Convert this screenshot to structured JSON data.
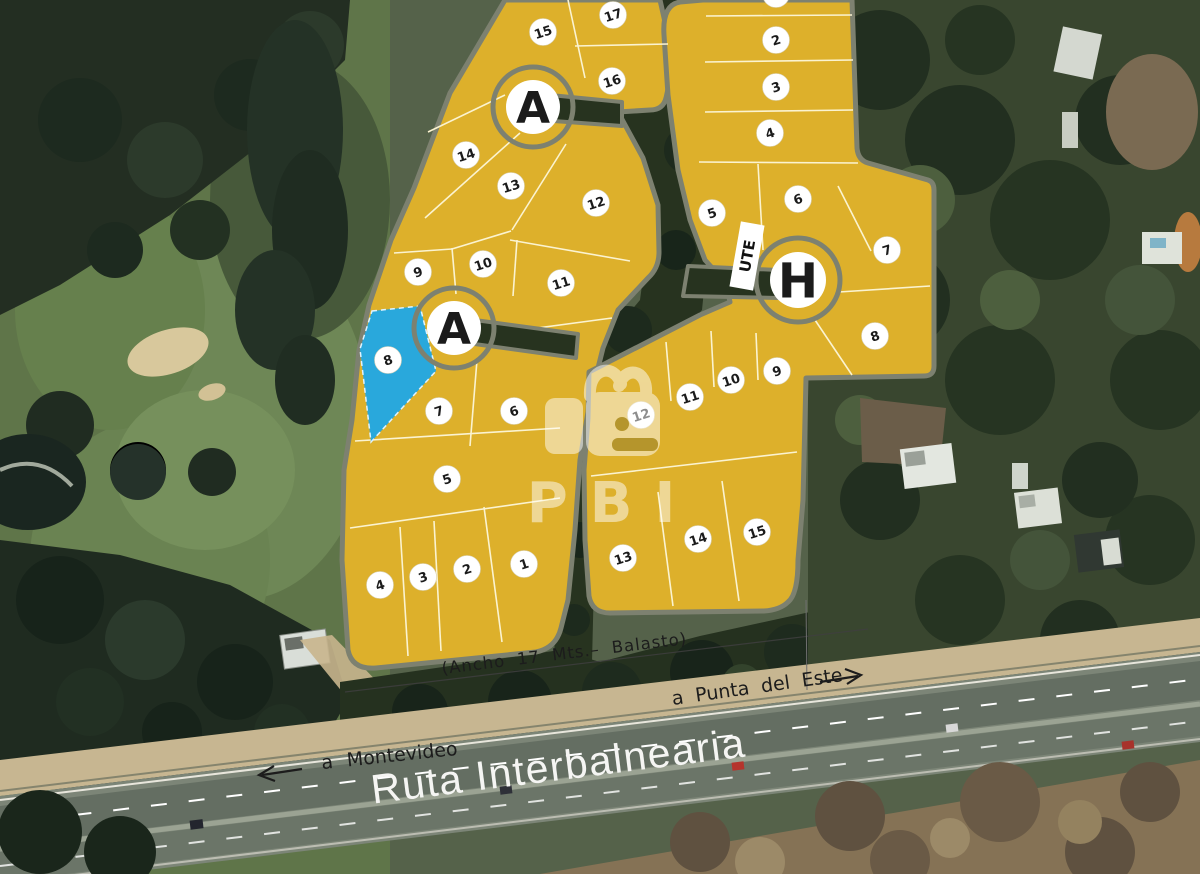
{
  "labels": {
    "route": "Ruta Interbalnearia",
    "to_left": "a  Montevideo",
    "to_right": "a  Punta del Este",
    "road_note": "(Ancho 17 Mts.– Balasto)",
    "utility": "UTE"
  },
  "watermark": {
    "brand": "PBI"
  },
  "colors": {
    "plot_fill": "#DDB02B",
    "plot_stroke": "#7D8170",
    "lot_line": "#FBF3D0",
    "highlight": "#29A8DC",
    "badge_bg": "#FFFFFF",
    "badge_ink": "#1B1B1B",
    "label_ink": "#1C1C1C",
    "route_text": "#F5F5F3"
  },
  "culdesacs": [
    {
      "label": "A",
      "x": 533,
      "y": 107,
      "r": 27,
      "ring": 40,
      "fs": 44
    },
    {
      "label": "A",
      "x": 454,
      "y": 328,
      "r": 27,
      "ring": 40,
      "fs": 44
    },
    {
      "label": "H",
      "x": 798,
      "y": 280,
      "r": 28,
      "ring": 42,
      "fs": 48
    }
  ],
  "sectors": [
    {
      "name": "A",
      "lots": [
        {
          "n": "17",
          "x": 613,
          "y": 15
        },
        {
          "n": "15",
          "x": 543,
          "y": 32
        },
        {
          "n": "16",
          "x": 612,
          "y": 81
        },
        {
          "n": "14",
          "x": 466,
          "y": 155
        },
        {
          "n": "13",
          "x": 511,
          "y": 186
        },
        {
          "n": "12",
          "x": 596,
          "y": 203
        },
        {
          "n": "9",
          "x": 418,
          "y": 272
        },
        {
          "n": "10",
          "x": 483,
          "y": 264
        },
        {
          "n": "11",
          "x": 561,
          "y": 283
        },
        {
          "n": "8",
          "x": 388,
          "y": 360,
          "highlighted": true
        },
        {
          "n": "7",
          "x": 439,
          "y": 411
        },
        {
          "n": "6",
          "x": 514,
          "y": 411
        },
        {
          "n": "5",
          "x": 447,
          "y": 479
        },
        {
          "n": "4",
          "x": 380,
          "y": 585
        },
        {
          "n": "3",
          "x": 423,
          "y": 577
        },
        {
          "n": "2",
          "x": 467,
          "y": 569
        },
        {
          "n": "1",
          "x": 524,
          "y": 564
        }
      ]
    },
    {
      "name": "H",
      "lots": [
        {
          "n": "1",
          "x": 776,
          "y": -6
        },
        {
          "n": "2",
          "x": 776,
          "y": 40
        },
        {
          "n": "3",
          "x": 776,
          "y": 87
        },
        {
          "n": "4",
          "x": 770,
          "y": 133
        },
        {
          "n": "5",
          "x": 712,
          "y": 213
        },
        {
          "n": "6",
          "x": 798,
          "y": 199
        },
        {
          "n": "7",
          "x": 887,
          "y": 250
        },
        {
          "n": "8",
          "x": 875,
          "y": 336
        },
        {
          "n": "9",
          "x": 777,
          "y": 371
        },
        {
          "n": "10",
          "x": 731,
          "y": 380
        },
        {
          "n": "11",
          "x": 690,
          "y": 397
        },
        {
          "n": "12",
          "x": 641,
          "y": 415
        },
        {
          "n": "13",
          "x": 623,
          "y": 558
        },
        {
          "n": "14",
          "x": 698,
          "y": 539
        },
        {
          "n": "15",
          "x": 757,
          "y": 532
        }
      ]
    }
  ],
  "highlighted_lot": {
    "sector": "A",
    "number": "8"
  }
}
